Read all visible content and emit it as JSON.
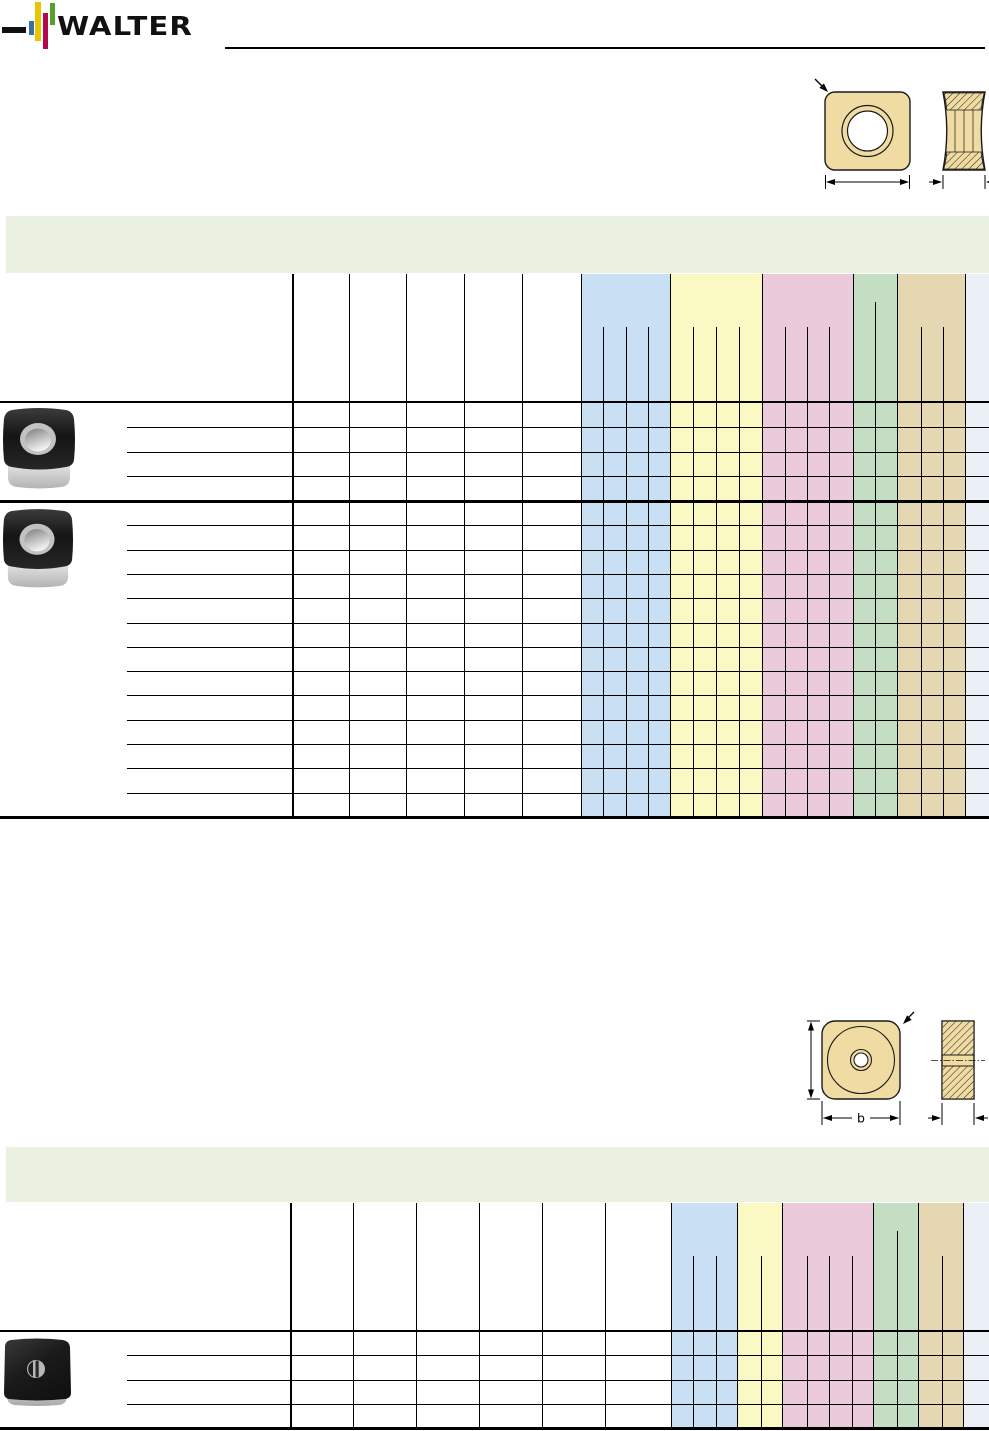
{
  "brand": {
    "name": "WALTER"
  },
  "colors": {
    "title_band": "#eaf1e1",
    "band_blue": "#c9dff4",
    "band_yellow": "#faf9c4",
    "band_pink": "#eacadb",
    "band_green": "#c3dec3",
    "band_tan": "#e5d7b1",
    "band_lavender": "#ebeff6",
    "insert_gold": "#f0dca2",
    "logo_blue": "#3a6fa6",
    "logo_yellow": "#e9c503",
    "logo_red": "#b3094a",
    "logo_green": "#55a02e",
    "line": "#000000"
  },
  "drawings": {
    "square_insert_top": {
      "name": "square-insert-with-round-hole"
    },
    "square_insert_bottom": {
      "name": "square-insert-with-center-bore",
      "width_label": "b"
    }
  },
  "tables": [
    {
      "name": "insert-table-1",
      "title_band": {
        "x": 6,
        "y": 216,
        "w": 983,
        "h": 57
      },
      "header_top": 274,
      "subline_top": 327,
      "tall_subline_top": 302,
      "body_top": 402,
      "body_bottom": 817,
      "row_line_indent": 127,
      "white_lines": [
        292,
        349,
        406,
        464,
        522,
        581
      ],
      "bands": [
        {
          "color": "band_blue",
          "x": 581,
          "w": 89,
          "subs": [
            603,
            626,
            648
          ]
        },
        {
          "color": "band_yellow",
          "x": 670,
          "w": 92,
          "subs": [
            693,
            716,
            739
          ]
        },
        {
          "color": "band_pink",
          "x": 762,
          "w": 91,
          "subs": [
            785,
            807,
            829
          ]
        },
        {
          "color": "band_green",
          "x": 853,
          "w": 44,
          "subs": [
            875
          ],
          "tall_subs": true
        },
        {
          "color": "band_tan",
          "x": 897,
          "w": 68,
          "subs": [
            921,
            943
          ]
        },
        {
          "color": "band_lavender",
          "x": 965,
          "w": 24,
          "subs": []
        }
      ],
      "groups": [
        {
          "top": 402,
          "bottom": 501,
          "rows": 4
        },
        {
          "top": 501,
          "bottom": 817,
          "rows": 13
        }
      ]
    },
    {
      "name": "insert-table-2",
      "title_band": {
        "x": 6,
        "y": 1147,
        "w": 983,
        "h": 55
      },
      "header_top": 1203,
      "subline_top": 1256,
      "tall_subline_top": 1231,
      "body_top": 1331,
      "body_bottom": 1428,
      "row_line_indent": 127,
      "white_lines": [
        290,
        353,
        416,
        479,
        542,
        605
      ],
      "bands": [
        {
          "color": "band_blue",
          "x": 671,
          "w": 66,
          "subs": [
            693,
            716
          ]
        },
        {
          "color": "band_yellow",
          "x": 737,
          "w": 45,
          "subs": [
            761
          ]
        },
        {
          "color": "band_pink",
          "x": 782,
          "w": 91,
          "subs": [
            807,
            829,
            852
          ]
        },
        {
          "color": "band_green",
          "x": 873,
          "w": 45,
          "subs": [
            897
          ],
          "tall_subs": true
        },
        {
          "color": "band_tan",
          "x": 918,
          "w": 45,
          "subs": [
            942
          ]
        },
        {
          "color": "band_lavender",
          "x": 963,
          "w": 26,
          "subs": []
        }
      ],
      "groups": [
        {
          "top": 1331,
          "bottom": 1428,
          "rows": 4
        }
      ]
    }
  ]
}
